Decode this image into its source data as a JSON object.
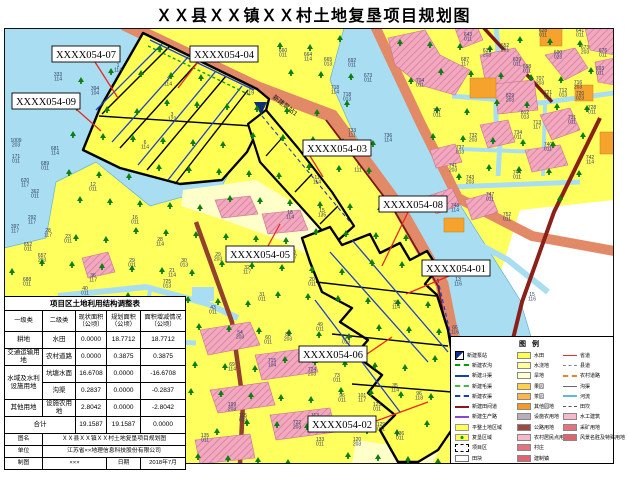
{
  "title": "ＸＸ县ＸＸ镇ＸＸ村土地复垦项目规划图",
  "colors": {
    "water": "#a9def2",
    "farmland": "#ffff5e",
    "dry_strip": "#ffffc9",
    "road": "#e28a68",
    "field_road": "#8a2018",
    "settlement": "#f2a8bf",
    "orchard": "#f5a32c",
    "boundary": "#000000",
    "canal": "#2040cc",
    "leader": "#e8281e",
    "pump": "#0d2f7a"
  },
  "map": {
    "pump_station_label": "新建泵站1",
    "callouts": [
      {
        "label": "XXXX054-07",
        "x": 52,
        "y": 46,
        "leader": [
          [
            95,
            62
          ],
          [
            118,
            98
          ]
        ]
      },
      {
        "label": "XXXX054-04",
        "x": 190,
        "y": 46,
        "leader": [
          [
            198,
            62
          ],
          [
            178,
            88
          ]
        ]
      },
      {
        "label": "XXXX054-09",
        "x": 12,
        "y": 93,
        "leader": [
          [
            76,
            109
          ],
          [
            101,
            131
          ]
        ]
      },
      {
        "label": "XXXX054-03",
        "x": 303,
        "y": 140,
        "leader": [
          [
            310,
            156
          ],
          [
            323,
            177
          ]
        ]
      },
      {
        "label": "XXXX054-08",
        "x": 379,
        "y": 196,
        "leader": [
          [
            408,
            212
          ],
          [
            382,
            266
          ]
        ]
      },
      {
        "label": "XXXX054-01",
        "x": 422,
        "y": 260,
        "leader": [
          [
            449,
            276
          ],
          [
            406,
            294
          ]
        ]
      },
      {
        "label": "XXXX054-05",
        "x": 226,
        "y": 246,
        "leader": [
          [
            268,
            246
          ],
          [
            280,
            224
          ]
        ]
      },
      {
        "label": "XXXX054-06",
        "x": 299,
        "y": 346,
        "leader": [
          [
            367,
            354
          ],
          [
            392,
            337
          ]
        ]
      },
      {
        "label": "XXXX054-02",
        "x": 308,
        "y": 416,
        "leader": [
          [
            376,
            421
          ],
          [
            428,
            402
          ]
        ]
      }
    ],
    "parcels": [
      [
        58,
        76,
        "333",
        "114"
      ],
      [
        95,
        90,
        "394",
        "104"
      ],
      [
        16,
        142,
        "1009",
        "203"
      ],
      [
        55,
        150,
        "681",
        "114"
      ],
      [
        45,
        165,
        "689",
        "011"
      ],
      [
        25,
        182,
        "620",
        "117"
      ],
      [
        16,
        158,
        "171",
        "011"
      ],
      [
        35,
        193,
        "362",
        "011"
      ],
      [
        32,
        219,
        "292",
        "117"
      ],
      [
        15,
        228,
        "397",
        "117"
      ],
      [
        28,
        246,
        "652",
        "011"
      ],
      [
        42,
        257,
        "657",
        "203"
      ],
      [
        27,
        281,
        "688",
        "011"
      ],
      [
        68,
        238,
        "23",
        "011"
      ],
      [
        48,
        232,
        "28",
        "117"
      ],
      [
        93,
        277,
        "36",
        "117"
      ],
      [
        85,
        290,
        "40",
        "011"
      ],
      [
        93,
        186,
        "12",
        "011"
      ],
      [
        135,
        219,
        "16",
        "011"
      ],
      [
        132,
        262,
        "29",
        "011"
      ],
      [
        160,
        241,
        "28",
        "114"
      ],
      [
        172,
        272,
        "21",
        "114"
      ],
      [
        184,
        262,
        "30",
        "013"
      ],
      [
        167,
        283,
        "725",
        "013"
      ],
      [
        218,
        256,
        "29",
        "203"
      ],
      [
        247,
        269,
        "32",
        "117"
      ],
      [
        312,
        281,
        "20",
        "011"
      ],
      [
        262,
        296,
        "31",
        "011"
      ],
      [
        213,
        309,
        "43",
        "011"
      ],
      [
        320,
        326,
        "49",
        "011"
      ],
      [
        240,
        334,
        "54",
        "203"
      ],
      [
        268,
        339,
        "60",
        "011"
      ],
      [
        288,
        336,
        "85",
        "203"
      ],
      [
        272,
        362,
        "715",
        "104"
      ],
      [
        232,
        366,
        "69",
        "114"
      ],
      [
        312,
        371,
        "724",
        "203"
      ],
      [
        337,
        377,
        "73",
        "011"
      ],
      [
        346,
        339,
        "728",
        "013"
      ],
      [
        396,
        304,
        "30",
        "114"
      ],
      [
        395,
        387,
        "35",
        "114"
      ],
      [
        419,
        395,
        "96",
        "118"
      ],
      [
        342,
        397,
        "96",
        "011"
      ],
      [
        362,
        397,
        "101",
        "117"
      ],
      [
        377,
        406,
        "123",
        "011"
      ],
      [
        315,
        417,
        "113",
        "011"
      ],
      [
        243,
        417,
        "115",
        "013"
      ],
      [
        232,
        406,
        "199",
        "203"
      ],
      [
        297,
        424,
        "722",
        "203"
      ],
      [
        320,
        441,
        "133",
        "011"
      ],
      [
        357,
        441,
        "120",
        "203"
      ],
      [
        381,
        426,
        "129",
        "011"
      ],
      [
        400,
        435,
        "136",
        "011"
      ],
      [
        205,
        437,
        "135",
        "011"
      ],
      [
        455,
        329,
        "66",
        "116"
      ],
      [
        532,
        296,
        "15",
        "116"
      ],
      [
        458,
        281,
        "13",
        "116"
      ],
      [
        118,
        67,
        "1",
        "114"
      ],
      [
        168,
        81,
        "2",
        "114"
      ],
      [
        172,
        116,
        "3",
        "122"
      ],
      [
        145,
        144,
        "6",
        "114"
      ],
      [
        250,
        90,
        "9",
        "119"
      ],
      [
        317,
        179,
        "11",
        "114"
      ],
      [
        358,
        167,
        "7",
        "111"
      ],
      [
        322,
        212,
        "15",
        "135"
      ],
      [
        290,
        214,
        "18",
        "114"
      ],
      [
        293,
        254,
        "10",
        "117"
      ],
      [
        283,
        52,
        "660",
        "011"
      ],
      [
        308,
        56,
        "664",
        "114"
      ],
      [
        328,
        61,
        "665",
        "013"
      ],
      [
        368,
        77,
        "673",
        "011"
      ],
      [
        352,
        62,
        "692",
        "011"
      ],
      [
        335,
        89,
        "718",
        "114"
      ],
      [
        347,
        96,
        "718",
        "013"
      ],
      [
        420,
        82,
        "704",
        "011"
      ],
      [
        437,
        112,
        "727",
        "011"
      ],
      [
        352,
        132,
        "733",
        "111"
      ],
      [
        388,
        137,
        "736",
        "114"
      ],
      [
        468,
        36,
        "643",
        "011"
      ],
      [
        543,
        32,
        "628",
        "011"
      ],
      [
        580,
        32,
        "641",
        "011"
      ],
      [
        505,
        47,
        "652",
        "201"
      ],
      [
        487,
        52,
        "639",
        "203"
      ],
      [
        585,
        49,
        "673",
        "203"
      ],
      [
        603,
        52,
        "676",
        "011"
      ],
      [
        558,
        54,
        "690",
        "023"
      ],
      [
        465,
        61,
        "687",
        "117"
      ],
      [
        517,
        61,
        "639",
        "011"
      ],
      [
        527,
        68,
        "698",
        "011"
      ],
      [
        600,
        70,
        "693",
        "011"
      ],
      [
        540,
        80,
        "707",
        "203"
      ],
      [
        578,
        84,
        "716",
        "203"
      ],
      [
        510,
        97,
        "829",
        "203"
      ],
      [
        548,
        94,
        "721",
        "011"
      ],
      [
        563,
        92,
        "712",
        "013"
      ],
      [
        580,
        95,
        "720",
        "023"
      ],
      [
        592,
        109,
        "728",
        "011"
      ],
      [
        525,
        114,
        "812",
        "013"
      ],
      [
        572,
        119,
        "731",
        "011"
      ],
      [
        537,
        124,
        "713",
        "117"
      ],
      [
        518,
        134,
        "734",
        "011"
      ],
      [
        473,
        137,
        "732",
        "203"
      ],
      [
        548,
        146,
        "740",
        "011"
      ],
      [
        590,
        159,
        "742",
        "114"
      ],
      [
        460,
        149,
        "737",
        "013"
      ],
      [
        453,
        167,
        "741",
        "203"
      ],
      [
        470,
        179,
        "743",
        "203"
      ],
      [
        517,
        174,
        "744",
        "011"
      ],
      [
        490,
        196,
        "747",
        "011"
      ],
      [
        455,
        207,
        "748",
        "114"
      ],
      [
        507,
        216,
        "752",
        "011"
      ]
    ]
  },
  "table": {
    "title": "项目区土地利用结构调整表",
    "headers": [
      "一级类",
      "二级类",
      "现状面积（公顷）",
      "规划面积（公顷）",
      "面积增减情况（公顷）"
    ],
    "col_widths": [
      38,
      33,
      31,
      34,
      45
    ],
    "rows": [
      {
        "c1": "耕地",
        "span": 1,
        "c2": "水田",
        "now": "0.0000",
        "plan": "18.7712",
        "change": "18.7712"
      },
      {
        "c1": "交通运输用地",
        "span": 1,
        "c2": "农村道路",
        "now": "0.0000",
        "plan": "0.3875",
        "change": "0.3875"
      },
      {
        "c1": "水域及水利设施用地",
        "span": 2,
        "c2": "坑塘水面",
        "now": "16.6708",
        "plan": "0.0000",
        "change": "-16.6708"
      },
      {
        "c1": null,
        "span": 0,
        "c2": "沟渠",
        "now": "0.2837",
        "plan": "0.0000",
        "change": "-0.2837"
      },
      {
        "c1": "其他用地",
        "span": 1,
        "c2": "设施农用地",
        "now": "2.8042",
        "plan": "0.0000",
        "change": "-2.8042"
      }
    ],
    "total": {
      "label": "合计",
      "now": "19.1587",
      "plan": "19.1587",
      "change": "0.0000"
    },
    "footer": {
      "name_label": "图名",
      "name_value": "ＸＸ县ＸＸ镇ＸＸ村土地复垦项目规划图",
      "unit_label": "单位",
      "unit_value": "江苏省××地理信息科技股份有限公司",
      "maker_label": "制图",
      "maker_value": "×××",
      "date_label": "日期",
      "date_value": "2018年7月"
    }
  },
  "legend": {
    "title": "图例",
    "col1": [
      {
        "sym": "pump-square",
        "label": "新建泵站"
      },
      {
        "sym": "green-dash",
        "label": "新建农沟"
      },
      {
        "sym": "blue-solid",
        "label": "新建斗渠"
      },
      {
        "sym": "green-dash2",
        "label": "新建毛渠"
      },
      {
        "sym": "blue-dash",
        "label": "新建农渠"
      },
      {
        "sym": "darkred-line",
        "label": "新建田间道"
      },
      {
        "sym": "purple-line",
        "label": "新建生产路"
      },
      {
        "sym": "fill-yellow",
        "label": "平整土地区域"
      },
      {
        "sym": "fill-yellow-dot",
        "label": "复垦区域"
      },
      {
        "sym": "black-dash-rect",
        "label": "项目区"
      },
      {
        "sym": "fill-white",
        "label": "田块"
      }
    ],
    "col2": [
      {
        "color": "#ffff54",
        "label": "水田"
      },
      {
        "color": "#ffff9b",
        "label": "水浇地"
      },
      {
        "color": "#ffffcf",
        "label": "旱地"
      },
      {
        "color": "#ffd04a",
        "label": "果园"
      },
      {
        "color": "#ffb54a",
        "label": "茶园"
      },
      {
        "color": "#f59a2a",
        "label": "其他园地"
      },
      {
        "color": "#b8aebc",
        "label": "设施农用地"
      },
      {
        "color": "#9c4a42",
        "label": "公路用地"
      },
      {
        "color": "#f6b9cb",
        "label": "农村居民点用地"
      },
      {
        "color": "#e4737f",
        "label": "村庄"
      },
      {
        "color": "#df6470",
        "label": "建制镇"
      }
    ],
    "col3": [
      {
        "sym": "red-line",
        "label": "省道"
      },
      {
        "sym": "gray-dash",
        "label": "县道"
      },
      {
        "sym": "orange-dashdot",
        "label": "农村道路"
      },
      {
        "sym": "thin-line",
        "label": "沟渠"
      },
      {
        "sym": "cyan-line",
        "label": "河流"
      },
      {
        "sym": "gray-dash2",
        "label": "田坎"
      },
      {
        "color": "#f6b9cb",
        "label": "水工建筑"
      },
      {
        "color": "#e4737f",
        "label": "采矿用地"
      },
      {
        "color": "#df6470",
        "label": "风景名胜及特殊用地"
      }
    ]
  }
}
